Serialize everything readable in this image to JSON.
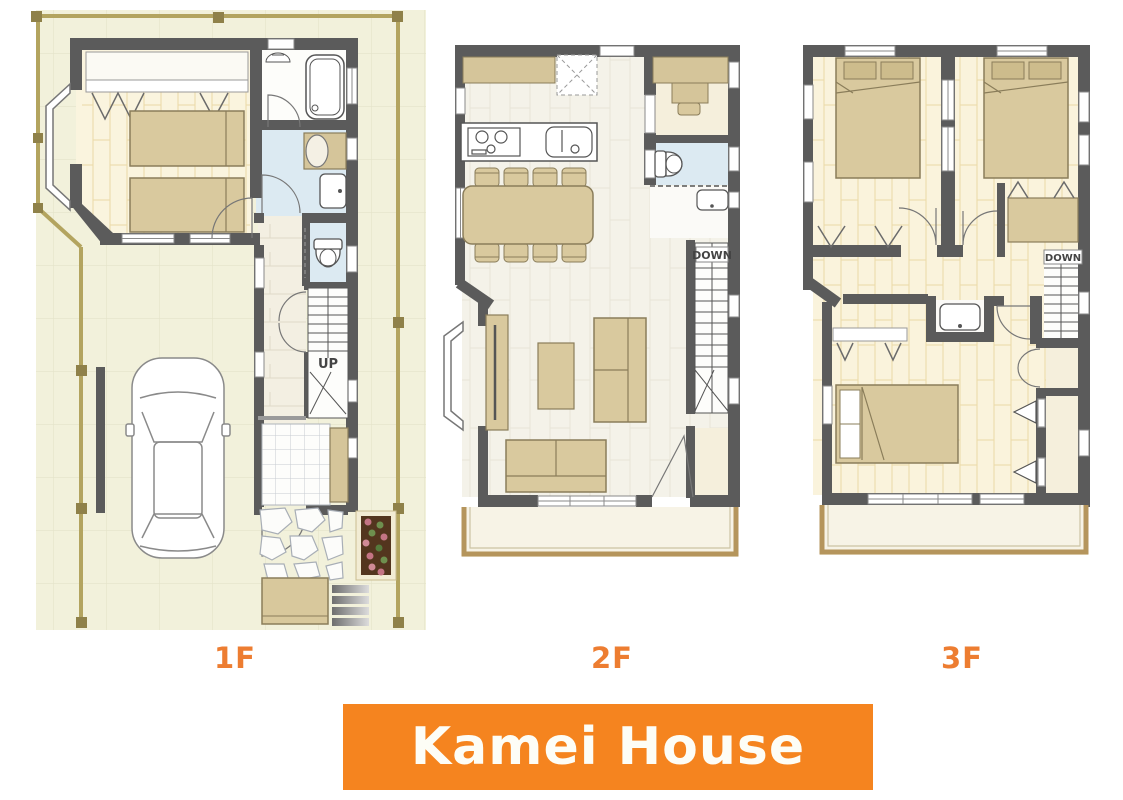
{
  "banner": {
    "title": "Kamei House"
  },
  "floors": [
    {
      "label": "1F",
      "stair_label": "UP"
    },
    {
      "label": "2F",
      "stair_label": "DOWN"
    },
    {
      "label": "3F",
      "stair_label": "DOWN"
    }
  ],
  "colors": {
    "banner_bg": "#F5841F",
    "banner_text": "#FDFDF6",
    "floor_label_text": "#ED7D31",
    "wall": "#5B5B5B",
    "site_ground": "#F2F1DB",
    "fence": "#B3A45F",
    "wood_floor": "#FAF3DC",
    "furniture": "#D9C99E",
    "water_room": "#DCEAF2",
    "balcony_edge": "#B5955C"
  }
}
